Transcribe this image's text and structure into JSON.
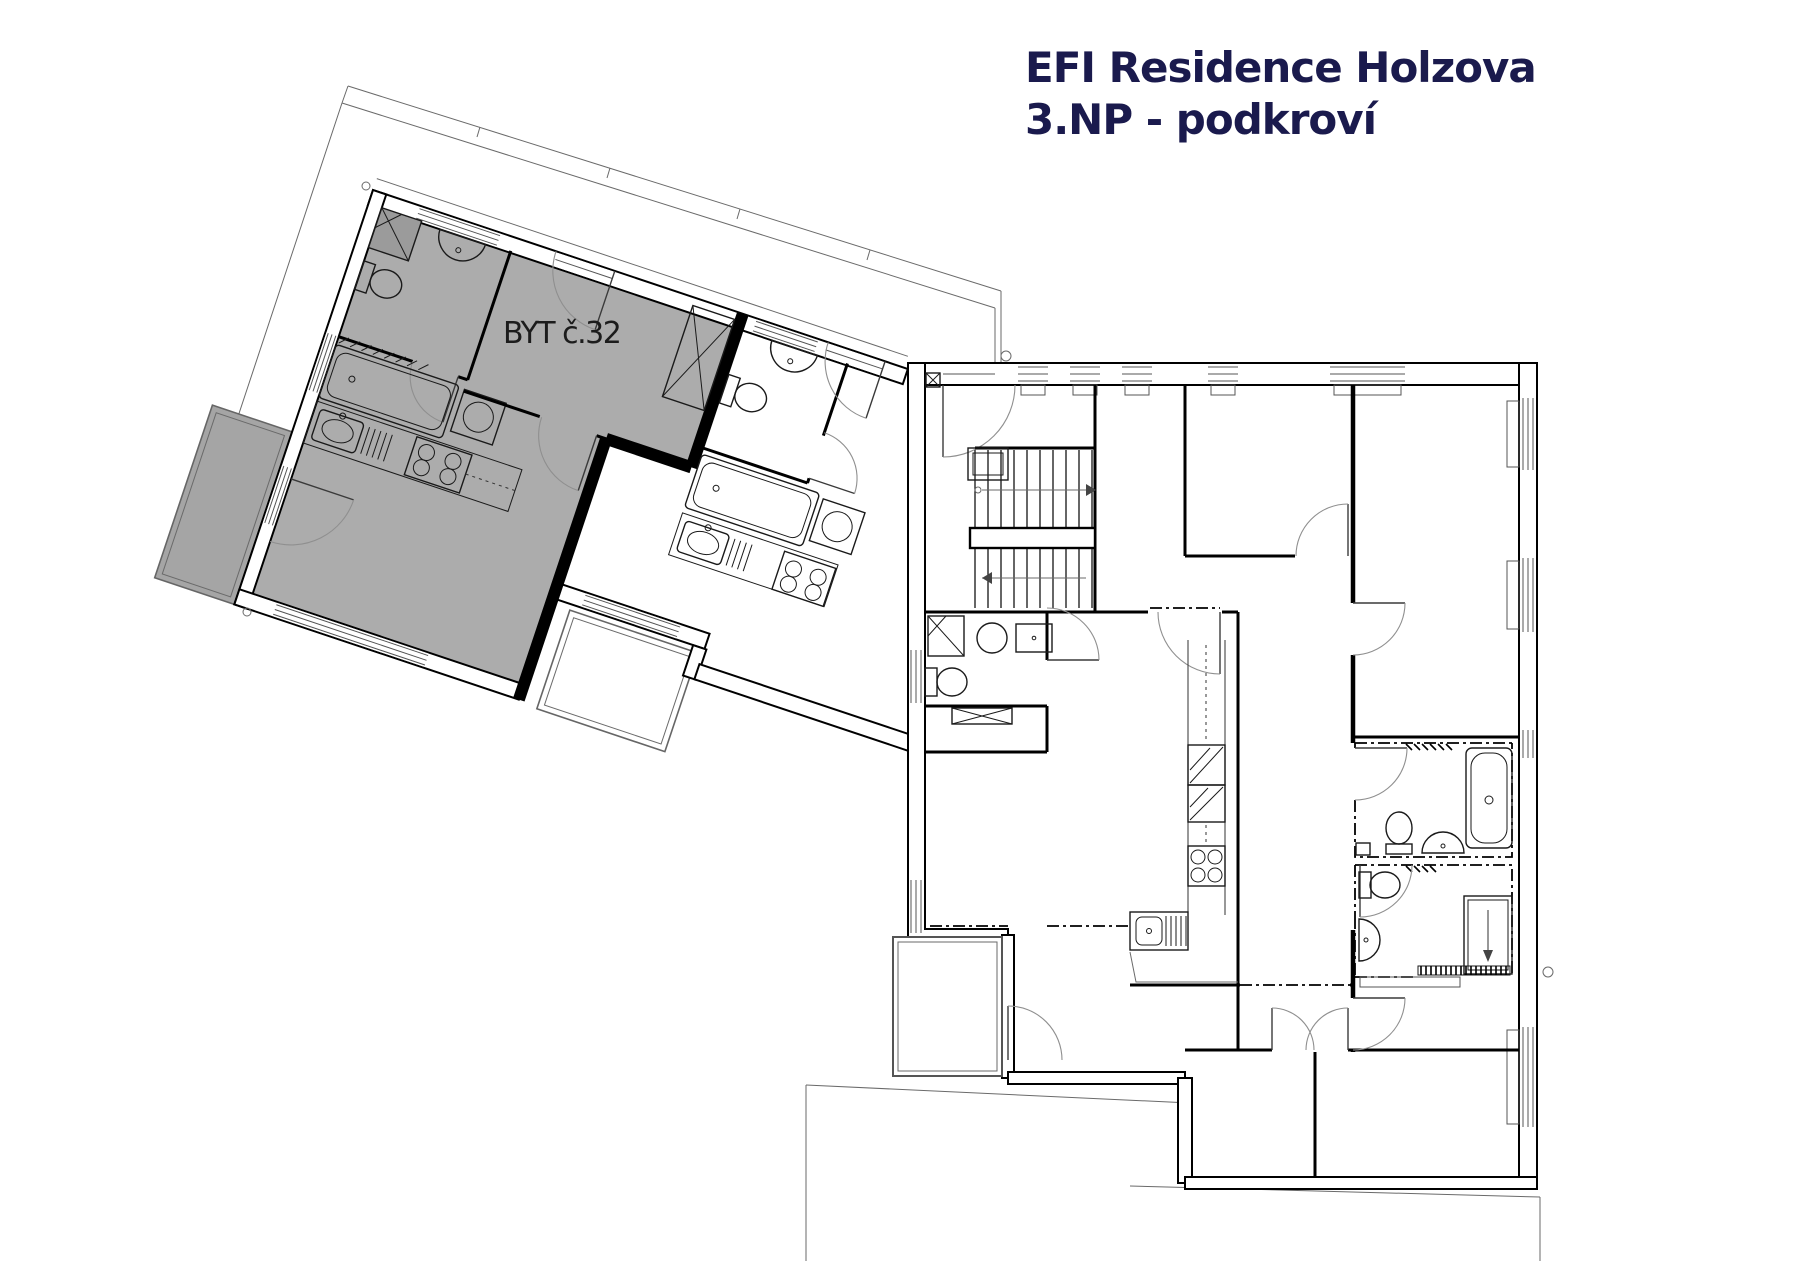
{
  "title": {
    "line1": "EFI Residence Holzova",
    "line2": "3.NP - podkroví"
  },
  "unit": {
    "label": "BYT č.32"
  },
  "colors": {
    "title_text": "#1a1a4d",
    "label_text": "#1c1c1c",
    "unit_fill": "#acacac",
    "terrace_fill": "#a5a5a5",
    "shower_fill": "#9b9b9b",
    "wall_line": "#000000",
    "thin_line": "#6a6a6a",
    "arc_line": "#8f8f8f"
  }
}
